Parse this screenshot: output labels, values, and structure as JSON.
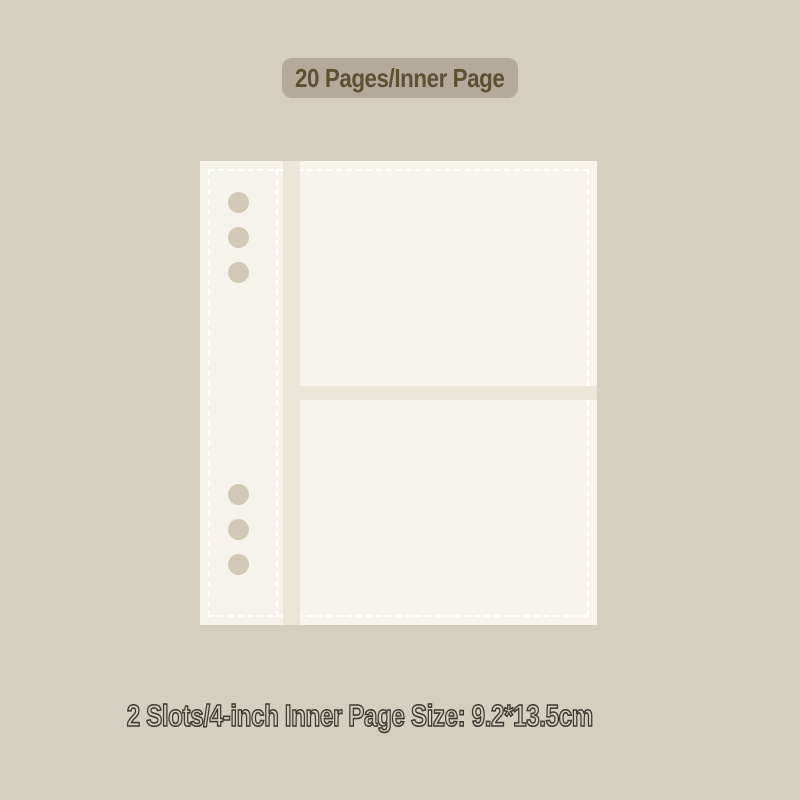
{
  "colors": {
    "background": "#d5cfc0",
    "badge_bg": "#b3aa9b",
    "badge_text": "#5d5134",
    "page_bg": "#f6f3ec",
    "slot_bg": "#f7f4ee",
    "divider": "#eae6d9",
    "hole": "#d2c8b6",
    "dash": "#ffffff",
    "caption_fill": "#d5cfc0",
    "caption_stroke": "#3e3931"
  },
  "badge": {
    "label": "20 Pages/Inner Page"
  },
  "caption": {
    "text": "2 Slots/4-inch Inner Page Size: 9.2*13.5cm"
  },
  "illustration": {
    "description": "6-hole binder inner page with 2 photo slots",
    "slot_count": 2,
    "hole_count": 6
  }
}
